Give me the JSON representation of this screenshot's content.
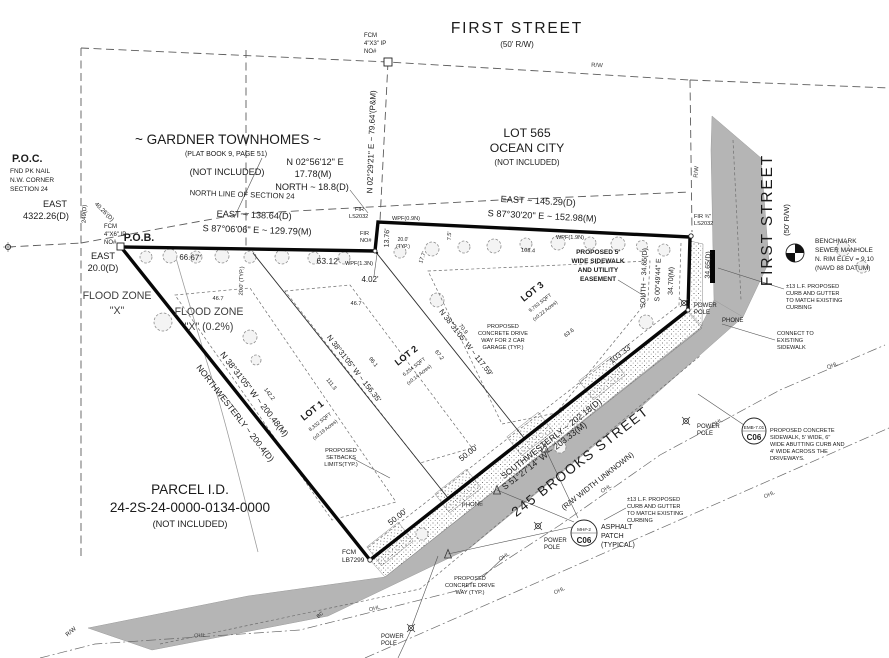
{
  "labels": {
    "first_street": "FIRST STREET",
    "first_street_rw": "(50' R/W)",
    "rw": "R/W",
    "lot565_line1": "LOT 565",
    "lot565_line2": "OCEAN CITY",
    "not_included": "(NOT INCLUDED)",
    "gardner": "~ GARDNER TOWNHOMES ~",
    "gardner_plat": "(PLAT BOOK 9, PAGE 51)",
    "poc": "P.O.C.",
    "poc_line1": "FND PK NAIL",
    "poc_line2": "N.W. CORNER",
    "poc_line3": "SECTION 24",
    "east": "EAST",
    "east_4322": "4322.26(D)",
    "d249": "249(D)",
    "d4026": "40.26'(D)",
    "fcm": "FCM",
    "fcm_4x3": "4\"X3\" IP",
    "fcm_4x6": "4\"X6\" IP",
    "no_num": "NO#",
    "pob": "P.O.B.",
    "east_20": "20.0(D)",
    "north_line": "NORTH LINE OF SECTION 24",
    "n0229": "N 02°29'21\" E ~ 79.64'(P&M)",
    "n0256": "N 02°56'12\" E",
    "m1778": "17.78(M)",
    "north_188": "NORTH ~ 18.8(D)",
    "east_13864": "EAST ~ 138.64(D)",
    "s8706": "S 87°06'06\" E ~ 129.79(M)",
    "east_14529": "EAST ~ 145.29(D)",
    "s8730": "S 87°30'20\" E ~ 152.98(M)",
    "d6667": "66.67'",
    "d6312": "63.12'",
    "d1376": "13.76'",
    "d402": "4.02'",
    "fir": "FIR",
    "ls2032": "LS2032",
    "fir34": "FIR ¾\"",
    "wpf09": "WPF(0.9N)",
    "wpf13": "WPF(1.3N)",
    "wpf19": "WPF(1.9N)",
    "d20typ": "20.0' (TYP.)",
    "d200": "20.0'",
    "typ": "(TYP.)",
    "d177": "17.7'",
    "d75": "7.5'",
    "d467": "46.7",
    "d1084": "108.4",
    "d1422": "142.2",
    "d1113": "111.3",
    "d961": "96.1",
    "d672": "67.2",
    "d709": "70.9",
    "d636": "63.6",
    "flood_zone": "FLOOD ZONE",
    "flood_x": "\"X\"",
    "flood_x02": "\"X\" (0.2%)",
    "nw_m": "N 38°31'05\" W ~ 200.48(M)",
    "nw_d": "NORTHWESTERLY ~ 200.4(D)",
    "lot_line_156": "N 38°31'05\" W ~ 156.35'",
    "lot_line_117": "N 38°31'05\" W ~ 117.59'",
    "sw_d": "SOUTHWESTERLY ~ 202.18(D)",
    "sw_m": "S 51°27'14\" W ~ 203.33(M)",
    "d50": "50.00'",
    "d10333": "103.33'",
    "brooks": "245 BROOKS STREET",
    "brooks_rw": "(R/W WIDTH UNKNOWN)",
    "parcel_title": "PARCEL I.D.",
    "parcel_id": "24-2S-24-0000-0134-0000",
    "fcm_lb": "LB7299",
    "south_full": "SOUTH ~ 34.65(D)",
    "d3465": "34.65(D)",
    "s0049": "S 00°49'44\" E",
    "m3470": "34.70(M)",
    "power": "POWER",
    "pole": "POLE",
    "phone": "PHONE",
    "ohl": "OHL",
    "bc": "BC",
    "emb": "EMB-7.01",
    "c06": "C06",
    "mh": "MH#-2"
  },
  "blocks": {
    "sidewalk_esmt": [
      "PROPOSED 5'",
      "WIDE SIDEWALK",
      "AND UTILITY",
      "EASEMENT"
    ],
    "benchmark": [
      "BENCHMARK",
      "SEWER MANHOLE",
      "N. RIM ELEV = 9.10",
      "(NAVD 88 DATUM)"
    ],
    "curb_note": [
      "±13 L.F. PROPOSED",
      "CURB AND GUTTER",
      "TO MATCH EXISTING",
      "CURBING"
    ],
    "connect_note": [
      "CONNECT TO",
      "EXISTING",
      "SIDEWALK"
    ],
    "sidewalk_note": [
      "PROPOSED CONCRETE",
      "SIDEWALK, 5' WIDE, 6\"",
      "WIDE ABUTTING CURB AND",
      "4' WIDE ACROSS THE",
      "DRIVEWAYS."
    ],
    "driveway2_note": [
      "PROPOSED",
      "CONCRETE DRIVE",
      "WAY FOR 2 CAR",
      "GARAGE (TYP.)"
    ],
    "driveway_note": [
      "PROPOSED",
      "CONCRETE DRIVE",
      "WAY (TYP.)"
    ],
    "setback_note": [
      "PROPOSED",
      "SETBACKS",
      "LIMITS(TYP.)"
    ],
    "asphalt_note": [
      "ASPHALT",
      "PATCH",
      "(TYPICAL)"
    ]
  },
  "lots": [
    {
      "name": "LOT 1",
      "sqft": "8,332 SQFT",
      "acres": "(±0.19 Acres)"
    },
    {
      "name": "LOT 2",
      "sqft": "6,254 SQFT",
      "acres": "(±0.14 Acres)"
    },
    {
      "name": "LOT 3",
      "sqft": "9,763 SQFT",
      "acres": "(±0.22 Acres)"
    }
  ]
}
